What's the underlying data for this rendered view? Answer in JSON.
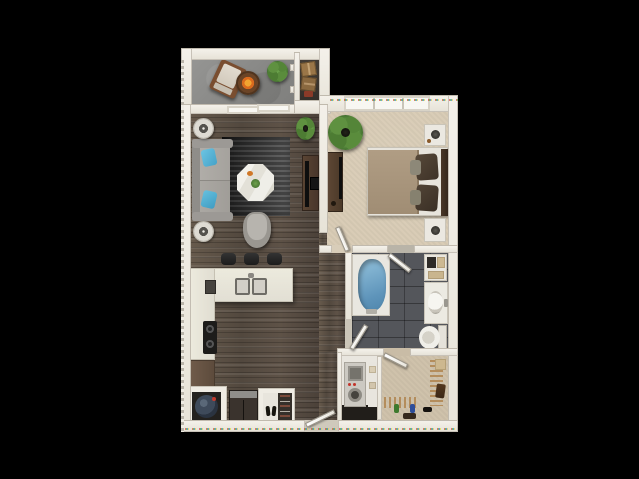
{
  "meta": {
    "type": "3d-floor-plan-rendering",
    "description": "Top-down 3D rendered one-bedroom, one-bathroom apartment floor plan centered on a black background. No text labels or dimensions are rendered in the image.",
    "background_color": "#000000"
  },
  "palette": {
    "wall": "#EFECE4",
    "wood_floor": "#5A5045",
    "bedroom_carpet": "#D9CCB6",
    "closet_carpet": "#CFC2AB",
    "bathroom_tile": "#54565B",
    "balcony_concrete": "#8F8F8D",
    "bathtub_blue": "#74A5C9",
    "throw_pillow_blue": "#5CB8DA",
    "plant_green": "#4F7A36",
    "fire_pit_orange": "#E07820",
    "cabinet_brown": "#6B5747",
    "countertop_white": "#E8E6DD"
  },
  "rooms": {
    "balcony": {
      "label": "Balcony",
      "items": [
        "lounge-chair",
        "fire-pit-table",
        "potted-plant",
        "sliding-glass-door"
      ]
    },
    "storage": {
      "label": "Storage closet",
      "items": [
        "cardboard-boxes"
      ]
    },
    "living": {
      "label": "Living room",
      "items": [
        "sofa",
        "blue-throw-pillows",
        "end-table-lamp-x2",
        "area-rug",
        "octagon-coffee-table",
        "accent-chair",
        "media-console",
        "tv",
        "floor-plant"
      ]
    },
    "bedroom": {
      "label": "Bedroom",
      "items": [
        "bed",
        "nightstand-lamp-x2",
        "dresser",
        "tv",
        "floor-plant",
        "triple-window"
      ]
    },
    "kitchen": {
      "label": "Kitchen",
      "items": [
        "island-double-sink",
        "bar-stool-x3",
        "cooktop",
        "counter",
        "base-cabinet",
        "refrigerator",
        "pantry-shelves",
        "water-heater-closet"
      ]
    },
    "bathroom": {
      "label": "Bathroom",
      "items": [
        "bathtub",
        "vanity-sink",
        "toilet",
        "linen-shelf-baskets"
      ]
    },
    "laundry": {
      "label": "Laundry closet",
      "items": [
        "stacked-washer-dryer",
        "towel-shelf"
      ]
    },
    "closet": {
      "label": "Walk-in closet",
      "items": [
        "hanging-rods",
        "hangers",
        "shoes",
        "storage-box",
        "garment-bag"
      ]
    },
    "entry": {
      "label": "Entry",
      "items": [
        "entry-door"
      ]
    }
  }
}
